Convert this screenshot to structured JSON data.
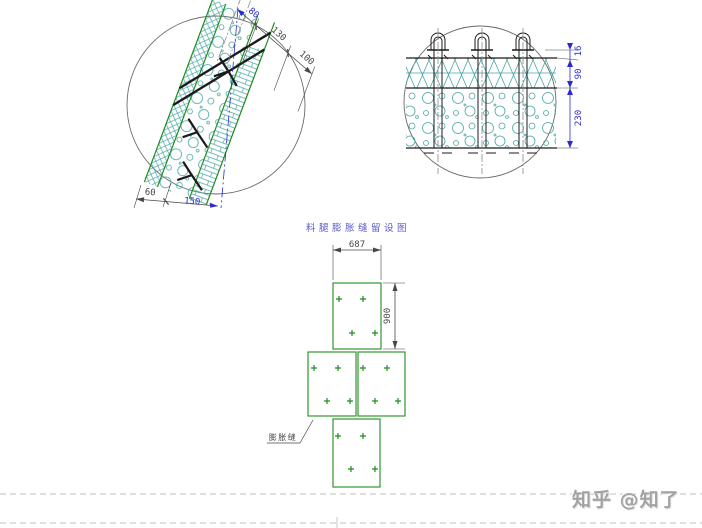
{
  "colors": {
    "green": "#1f8c1f",
    "teal": "#4aa6a6",
    "dim_blue": "#2a2ace",
    "dim_dark": "#474747",
    "line_dark": "#1b1b1b",
    "sheet_gray": "#c2c2c2",
    "title_blue": "#5b5bd0",
    "watermark_gray": "#a2a2a2"
  },
  "left_detail": {
    "dims_slope": [
      "80",
      "130",
      "100"
    ],
    "dims_base": [
      "60",
      "150"
    ]
  },
  "right_detail": {
    "dims_vertical": [
      "16",
      "90",
      "230"
    ]
  },
  "plan": {
    "title": "料腿膨胀缝留设图",
    "dim_width": "687",
    "dim_height": "900",
    "joint_label": "膨胀缝"
  },
  "watermark": {
    "text": "知乎 @知了"
  }
}
